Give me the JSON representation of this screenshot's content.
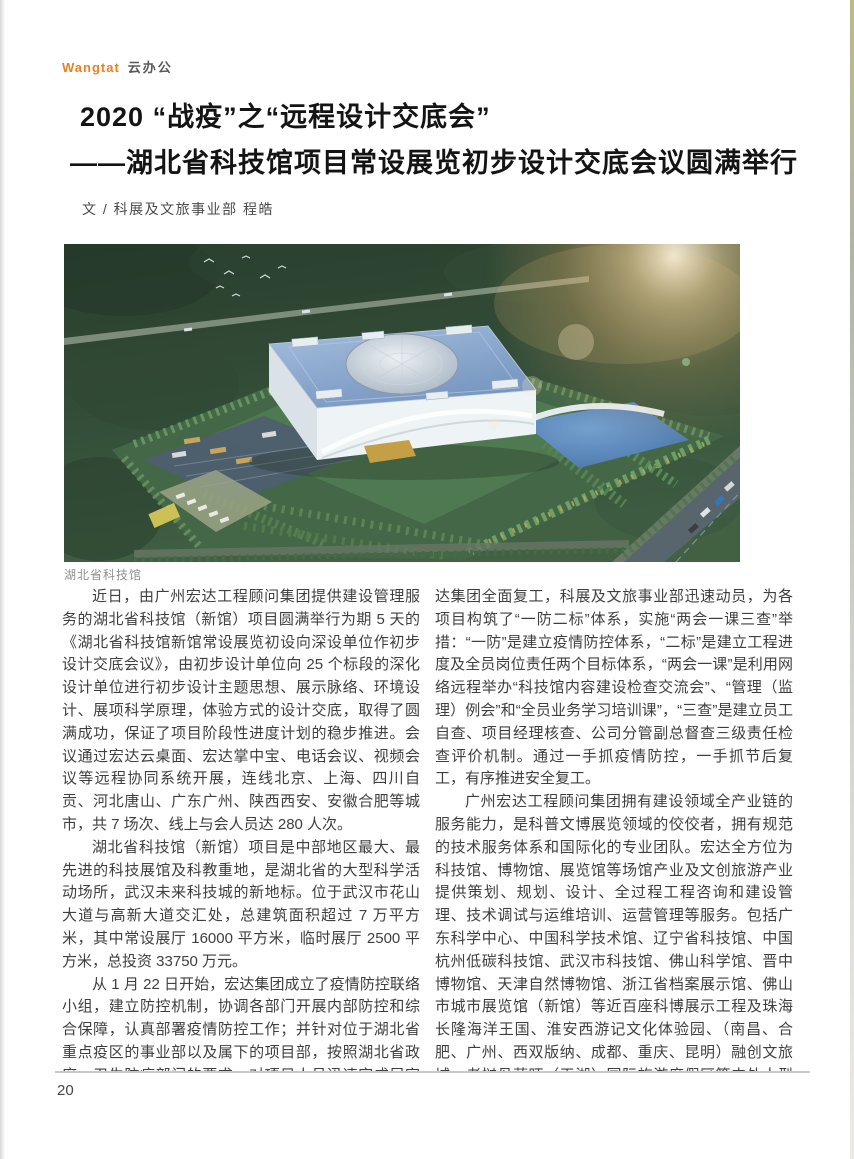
{
  "brand": {
    "en": "Wangtat",
    "cn": "云办公"
  },
  "title": {
    "line1": "2020 “战疫”之“远程设计交底会”",
    "line2": "——湖北省科技馆项目常设展览初步设计交底会议圆满举行"
  },
  "byline": "文 /  科展及文旅事业部  程皓",
  "photo": {
    "caption": "湖北省科技馆"
  },
  "article": {
    "left_paragraphs": [
      {
        "text": "近日，由广州宏达工程顾问集团提供建设管理服务的湖北省科技馆（新馆）项目圆满举行为期 5 天的《湖北省科技馆新馆常设展览初设向深设单位作初步设计交底会议》，由初步设计单位向 25 个标段的深化设计单位进行初步设计主题思想、展示脉络、环境设计、展项科学原理，体验方式的设计交底，取得了圆满成功，保证了项目阶段性进度计划的稳步推进。会议通过宏达云桌面、宏达掌中宝、电话会议、视频会议等远程协同系统开展，连线北京、上海、四川自贡、河北唐山、广东广州、陕西西安、安徽合肥等城市，共 7 场次、线上与会人员达 280 人次。"
      },
      {
        "text": "湖北省科技馆（新馆）项目是中部地区最大、最先进的科技展馆及科教重地，是湖北省的大型科学活动场所，武汉未来科技城的新地标。位于武汉市花山大道与高新大道交汇处，总建筑面积超过 7 万平方米，其中常设展厅 16000 平方米，临时展厅 2500 平方米，总投资 33750 万元。"
      },
      {
        "text": "从 1 月 22 日开始，宏达集团成立了疫情防控联络小组，建立防控机制，协调各部门开展内部防控和综合保障，认真部署疫情防控工作；并针对位于湖北省重点疫区的事业部以及属下的项目部，按照湖北省政府、卫生防疫部门的要求，对项目人员迅速完成居家隔离布置，做好自我防护、健康监察及个人健康状况信息采集登记上报等事项。2 月 10 日，宏"
      }
    ],
    "right_paragraphs": [
      {
        "text": "达集团全面复工，科展及文旅事业部迅速动员，为各项目构筑了“一防二标”体系，实施“两会一课三查”举措：“一防”是建立疫情防控体系，“二标”是建立工程进度及全员岗位责任两个目标体系，“两会一课”是利用网络远程举办“科技馆内容建设检查交流会”、“管理（监理）例会”和“全员业务学习培训课”，“三查”是建立员工自查、项目经理核查、公司分管副总督查三级责任检查评价机制。通过一手抓疫情防控，一手抓节后复工，有序推进安全复工。"
      },
      {
        "text": "广州宏达工程顾问集团拥有建设领域全产业链的服务能力，是科普文博展览领域的佼佼者，拥有规范的技术服务体系和国际化的专业团队。宏达全方位为科技馆、博物馆、展览馆等场馆产业及文创旅游产业提供策划、规划、设计、全过程工程咨询和建设管理、技术调试与运维培训、运营管理等服务。包括广东科学中心、中国科学技术馆、辽宁省科技馆、中国杭州低碳科技馆、武汉市科技馆、佛山科学馆、晋中博物馆、天津自然博物馆、浙江省档案展示馆、佛山市城市展览馆（新馆）等近百座科博展示工程及珠海长隆海洋王国、淮安西游记文化体验园、（南昌、合肥、广州、西双版纳、成都、重庆、昆明）融创文旅城、老挝丹萨旺（天湖）国际旅游度假区等中外大型文旅项目，在业界拥有优秀的口碑。"
      }
    ],
    "end_mark": "WT"
  },
  "footer": {
    "page_number": "20"
  },
  "colors": {
    "brand_orange": "#e8821e",
    "end_mark_red": "#c8161d",
    "body_text": "#3f3f3f"
  }
}
